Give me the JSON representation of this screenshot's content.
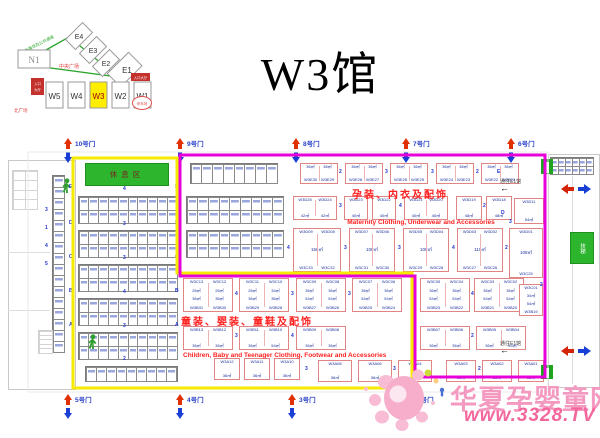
{
  "title": "W3馆",
  "minimap": {
    "halls_diagonal": [
      "E4",
      "E3",
      "E2",
      "E1"
    ],
    "hall_n1": "N1",
    "halls_bottom": [
      "W5",
      "W4",
      "W3",
      "W2",
      "W1"
    ],
    "highlighted": "W3",
    "highlight_color": "#ffee00",
    "green_note": "室外展场及公共通道",
    "plaza_label": "中央广场",
    "corner_label": "北广场",
    "entrance_left_1": "入口",
    "entrance_left_2": "大厅",
    "entrance_right": "入口大厅",
    "oval_label": "停车场"
  },
  "plan": {
    "rest_area": "休息区",
    "escalator": "扶梯",
    "corridor_top": {
      "text": "通往E1馆",
      "arrow": "←"
    },
    "corridor_bottom": {
      "text": "通往E1馆",
      "arrow": "←"
    },
    "categories": {
      "maternity_zh": "孕装、内衣及配饰",
      "maternity_en": "Maternity Clothing, Underwear and Accessories",
      "children_zh": "童装、婴装、童鞋及配饰",
      "children_en": "Children, Baby and Teenager Clothing, Footwear and Accessories"
    },
    "gates_top": [
      {
        "x": 62,
        "label": "10号门"
      },
      {
        "x": 174,
        "label": "9号门"
      },
      {
        "x": 290,
        "label": "8号门"
      },
      {
        "x": 400,
        "label": "7号门"
      },
      {
        "x": 505,
        "label": "6号门"
      }
    ],
    "gates_bottom": [
      {
        "x": 62,
        "label": "5号门"
      },
      {
        "x": 174,
        "label": "4号门"
      },
      {
        "x": 286,
        "label": "3号门"
      },
      {
        "x": 404,
        "label": "2号门"
      }
    ],
    "blocks": [
      {
        "x": 300,
        "y": 163,
        "w": 38,
        "h": 21,
        "cols": [
          {
            "area": "36㎡",
            "bot": "W3E30"
          },
          {
            "area": "36㎡",
            "bot": "W3E29"
          }
        ]
      },
      {
        "x": 345,
        "y": 163,
        "w": 38,
        "h": 21,
        "cols": [
          {
            "area": "36㎡",
            "bot": "W3E28"
          },
          {
            "area": "36㎡",
            "bot": "W3E27"
          }
        ]
      },
      {
        "x": 390,
        "y": 163,
        "w": 38,
        "h": 21,
        "cols": [
          {
            "area": "36㎡",
            "bot": "W3E26"
          },
          {
            "area": "36㎡",
            "bot": "W3E25"
          }
        ]
      },
      {
        "x": 436,
        "y": 163,
        "w": 38,
        "h": 21,
        "cols": [
          {
            "area": "36㎡",
            "bot": "W3E24"
          },
          {
            "area": "36㎡",
            "bot": "W3E23"
          }
        ]
      },
      {
        "x": 481,
        "y": 163,
        "w": 38,
        "h": 21,
        "cols": [
          {
            "area": "36㎡",
            "bot": "W3E22"
          },
          {
            "area": "36㎡",
            "bot": "W3E21"
          }
        ]
      },
      {
        "x": 293,
        "y": 196,
        "w": 44,
        "h": 24,
        "cols": [
          {
            "top": "W3D25",
            "area": "42㎡"
          },
          {
            "top": "W3D24",
            "area": "42㎡"
          }
        ]
      },
      {
        "x": 344,
        "y": 196,
        "w": 24,
        "h": 24,
        "cols": [
          {
            "top": "W3D23",
            "area": "40㎡"
          }
        ]
      },
      {
        "x": 372,
        "y": 196,
        "w": 24,
        "h": 24,
        "cols": [
          {
            "top": "W3D22",
            "area": "40㎡"
          }
        ]
      },
      {
        "x": 404,
        "y": 196,
        "w": 44,
        "h": 24,
        "cols": [
          {
            "top": "W3D21",
            "area": "40㎡"
          },
          {
            "top": "W3D20",
            "area": "40㎡"
          }
        ]
      },
      {
        "x": 456,
        "y": 196,
        "w": 26,
        "h": 24,
        "cols": [
          {
            "top": "W3D19",
            "area": "48㎡"
          }
        ]
      },
      {
        "x": 486,
        "y": 196,
        "w": 26,
        "h": 24,
        "cols": [
          {
            "top": "W3D18",
            "area": "48㎡"
          }
        ]
      },
      {
        "x": 514,
        "y": 198,
        "w": 30,
        "h": 26,
        "cols": [
          {
            "top": "W3D11",
            "area": "54㎡"
          }
        ]
      },
      {
        "x": 293,
        "y": 228,
        "w": 48,
        "h": 44,
        "bigArea": "156㎡",
        "cols": [
          {
            "top": "W3D09",
            "bot": "W3C33"
          },
          {
            "top": "W3D08",
            "bot": "W3C32"
          }
        ]
      },
      {
        "x": 349,
        "y": 228,
        "w": 46,
        "h": 44,
        "bigArea": "108㎡",
        "cols": [
          {
            "top": "W3D07",
            "bot": "W3C31"
          },
          {
            "top": "W3D06",
            "bot": "W3C30"
          }
        ]
      },
      {
        "x": 403,
        "y": 228,
        "w": 46,
        "h": 44,
        "bigArea": "108㎡",
        "cols": [
          {
            "top": "W3D05",
            "bot": "W3C29"
          },
          {
            "top": "W3D04",
            "bot": "W3C28"
          }
        ]
      },
      {
        "x": 457,
        "y": 228,
        "w": 46,
        "h": 44,
        "bigArea": "110㎡",
        "cols": [
          {
            "top": "W3D03",
            "bot": "W3C27"
          },
          {
            "top": "W3D02",
            "bot": "W3C26"
          }
        ]
      },
      {
        "x": 509,
        "y": 228,
        "w": 34,
        "h": 50,
        "bigArea": "108㎡",
        "cols": [
          {
            "top": "W3D01",
            "bot": "W3C25"
          }
        ]
      },
      {
        "x": 183,
        "y": 278,
        "w": 50,
        "h": 34,
        "cols": [
          {
            "top": "W3C13",
            "a1": "26㎡",
            "a2": "36㎡",
            "bot": "W3B31"
          },
          {
            "top": "W3C12",
            "a1": "26㎡",
            "a2": "36㎡",
            "bot": "W3B30"
          }
        ]
      },
      {
        "x": 239,
        "y": 278,
        "w": 50,
        "h": 34,
        "cols": [
          {
            "top": "W3C11",
            "a1": "26㎡",
            "a2": "36㎡",
            "bot": "W3B29"
          },
          {
            "top": "W3C10",
            "a1": "34㎡",
            "a2": "36㎡",
            "bot": "W3B28"
          }
        ]
      },
      {
        "x": 296,
        "y": 278,
        "w": 50,
        "h": 34,
        "cols": [
          {
            "top": "W3C09",
            "a1": "36㎡",
            "a2": "54㎡",
            "bot": "W3B27"
          },
          {
            "top": "W3C08",
            "a1": "36㎡",
            "a2": "54㎡",
            "bot": "W3B26"
          }
        ]
      },
      {
        "x": 352,
        "y": 278,
        "w": 50,
        "h": 34,
        "cols": [
          {
            "top": "W3C07",
            "a1": "36㎡",
            "a2": "54㎡",
            "bot": "W3B25"
          },
          {
            "top": "W3C06",
            "a1": "36㎡",
            "a2": "54㎡",
            "bot": "W3B24"
          }
        ]
      },
      {
        "x": 420,
        "y": 278,
        "w": 50,
        "h": 34,
        "cols": [
          {
            "top": "W3C05",
            "a1": "36㎡",
            "a2": "54㎡",
            "bot": "W3B23"
          },
          {
            "top": "W3C04",
            "a1": "36㎡",
            "a2": "54㎡",
            "bot": "W3B22"
          }
        ]
      },
      {
        "x": 474,
        "y": 278,
        "w": 50,
        "h": 34,
        "cols": [
          {
            "top": "W3C03",
            "a1": "36㎡",
            "a2": "54㎡",
            "bot": "W3B21"
          },
          {
            "top": "W3C02",
            "a1": "36㎡",
            "a2": "54㎡",
            "bot": "W3B20"
          }
        ]
      },
      {
        "x": 519,
        "y": 284,
        "w": 24,
        "h": 32,
        "cols": [
          {
            "top": "W3C01",
            "a1": "34㎡",
            "a2": "54㎡",
            "bot": "W3B19"
          }
        ]
      },
      {
        "x": 183,
        "y": 326,
        "w": 50,
        "h": 24,
        "cols": [
          {
            "top": "W3B13",
            "area": "36㎡"
          },
          {
            "top": "W3B12",
            "area": "36㎡"
          }
        ]
      },
      {
        "x": 239,
        "y": 326,
        "w": 50,
        "h": 24,
        "cols": [
          {
            "top": "W3B11",
            "area": "36㎡"
          },
          {
            "top": "W3B10",
            "area": "54㎡"
          }
        ]
      },
      {
        "x": 296,
        "y": 326,
        "w": 50,
        "h": 24,
        "cols": [
          {
            "top": "W3B09",
            "area": "36㎡"
          },
          {
            "top": "W3B08",
            "area": "36㎡"
          }
        ]
      },
      {
        "x": 420,
        "y": 326,
        "w": 50,
        "h": 24,
        "cols": [
          {
            "top": "W3B07",
            "area": "36㎡"
          },
          {
            "top": "W3B06",
            "area": "36㎡"
          }
        ]
      },
      {
        "x": 476,
        "y": 326,
        "w": 50,
        "h": 24,
        "cols": [
          {
            "top": "W3B05",
            "area": "36㎡"
          },
          {
            "top": "W3B04",
            "area": "54㎡"
          }
        ]
      },
      {
        "x": 214,
        "y": 358,
        "w": 26,
        "h": 22,
        "cols": [
          {
            "top": "W3A12",
            "area": "36㎡"
          }
        ]
      },
      {
        "x": 244,
        "y": 358,
        "w": 26,
        "h": 22,
        "cols": [
          {
            "top": "W3A11",
            "area": "36㎡"
          }
        ]
      },
      {
        "x": 274,
        "y": 358,
        "w": 26,
        "h": 22,
        "cols": [
          {
            "top": "W3A10",
            "area": "36㎡"
          }
        ]
      },
      {
        "x": 318,
        "y": 360,
        "w": 34,
        "h": 22,
        "cols": [
          {
            "top": "W3A08",
            "area": "36㎡"
          }
        ]
      },
      {
        "x": 358,
        "y": 360,
        "w": 34,
        "h": 22,
        "cols": [
          {
            "top": "W3A06",
            "area": "36㎡"
          }
        ]
      },
      {
        "x": 398,
        "y": 360,
        "w": 34,
        "h": 22,
        "cols": [
          {
            "top": "W3A04",
            "area": "36㎡"
          }
        ]
      },
      {
        "x": 446,
        "y": 360,
        "w": 30,
        "h": 22,
        "cols": [
          {
            "top": "W3A03",
            "area": "36㎡"
          }
        ]
      },
      {
        "x": 482,
        "y": 360,
        "w": 30,
        "h": 22,
        "cols": [
          {
            "top": "W3A02",
            "area": "36㎡"
          }
        ]
      },
      {
        "x": 518,
        "y": 360,
        "w": 26,
        "h": 22,
        "cols": [
          {
            "top": "W3A01",
            "area": "36㎡"
          }
        ]
      }
    ],
    "grids": [
      {
        "x": 78,
        "y": 196,
        "w": 100,
        "h": 28,
        "c": 10,
        "r": 2
      },
      {
        "x": 78,
        "y": 230,
        "w": 100,
        "h": 28,
        "c": 10,
        "r": 2
      },
      {
        "x": 78,
        "y": 264,
        "w": 100,
        "h": 28,
        "c": 10,
        "r": 2
      },
      {
        "x": 78,
        "y": 298,
        "w": 100,
        "h": 28,
        "c": 10,
        "r": 2
      },
      {
        "x": 78,
        "y": 332,
        "w": 100,
        "h": 28,
        "c": 10,
        "r": 2
      },
      {
        "x": 85,
        "y": 366,
        "w": 93,
        "h": 16,
        "c": 9,
        "r": 1
      },
      {
        "x": 190,
        "y": 163,
        "w": 88,
        "h": 21,
        "c": 8,
        "r": 1
      },
      {
        "x": 186,
        "y": 196,
        "w": 98,
        "h": 28,
        "c": 9,
        "r": 2
      },
      {
        "x": 186,
        "y": 230,
        "w": 98,
        "h": 28,
        "c": 9,
        "r": 2
      },
      {
        "x": 52,
        "y": 175,
        "w": 13,
        "h": 178,
        "c": 1,
        "r": 16
      },
      {
        "x": 550,
        "y": 157,
        "w": 44,
        "h": 18,
        "c": 6,
        "r": 2
      },
      {
        "x": 12,
        "y": 170,
        "w": 26,
        "h": 40,
        "c": 2,
        "r": 4,
        "light": true
      },
      {
        "x": 38,
        "y": 330,
        "w": 15,
        "h": 24,
        "c": 1,
        "r": 5,
        "light": true
      }
    ],
    "labels": [
      {
        "t": "E",
        "x": 69,
        "y": 185
      },
      {
        "t": "D",
        "x": 69,
        "y": 221
      },
      {
        "t": "C",
        "x": 69,
        "y": 255
      },
      {
        "t": "B",
        "x": 69,
        "y": 289
      },
      {
        "t": "A",
        "x": 69,
        "y": 323
      },
      {
        "t": "E",
        "x": 175,
        "y": 185
      },
      {
        "t": "D",
        "x": 175,
        "y": 221
      },
      {
        "t": "C",
        "x": 175,
        "y": 255
      },
      {
        "t": "B",
        "x": 175,
        "y": 289
      },
      {
        "t": "A",
        "x": 175,
        "y": 323
      },
      {
        "t": "4",
        "x": 123,
        "y": 187
      },
      {
        "t": "3",
        "x": 123,
        "y": 222
      },
      {
        "t": "3",
        "x": 123,
        "y": 256
      },
      {
        "t": "4",
        "x": 123,
        "y": 290
      },
      {
        "t": "3",
        "x": 123,
        "y": 324
      },
      {
        "t": "2",
        "x": 123,
        "y": 357
      },
      {
        "t": "3",
        "x": 45,
        "y": 208
      },
      {
        "t": "1",
        "x": 45,
        "y": 226
      },
      {
        "t": "4",
        "x": 45,
        "y": 244
      },
      {
        "t": "5",
        "x": 45,
        "y": 262
      },
      {
        "t": "2",
        "x": 339,
        "y": 170
      },
      {
        "t": "3",
        "x": 385,
        "y": 170
      },
      {
        "t": "3",
        "x": 431,
        "y": 170
      },
      {
        "t": "2",
        "x": 476,
        "y": 170
      },
      {
        "t": "3",
        "x": 339,
        "y": 204
      },
      {
        "t": "4",
        "x": 399,
        "y": 204
      },
      {
        "t": "2",
        "x": 483,
        "y": 204
      },
      {
        "t": "4",
        "x": 287,
        "y": 246
      },
      {
        "t": "3",
        "x": 344,
        "y": 246
      },
      {
        "t": "3",
        "x": 398,
        "y": 246
      },
      {
        "t": "4",
        "x": 452,
        "y": 246
      },
      {
        "t": "2",
        "x": 505,
        "y": 246
      },
      {
        "t": "4",
        "x": 235,
        "y": 292
      },
      {
        "t": "3",
        "x": 291,
        "y": 292
      },
      {
        "t": "3",
        "x": 348,
        "y": 292
      },
      {
        "t": "4",
        "x": 471,
        "y": 292
      },
      {
        "t": "3",
        "x": 235,
        "y": 334
      },
      {
        "t": "4",
        "x": 291,
        "y": 334
      },
      {
        "t": "2",
        "x": 471,
        "y": 334
      },
      {
        "t": "3",
        "x": 305,
        "y": 367
      },
      {
        "t": "3",
        "x": 393,
        "y": 367
      },
      {
        "t": "2",
        "x": 478,
        "y": 367
      },
      {
        "t": "E",
        "x": 497,
        "y": 170
      },
      {
        "t": "D",
        "x": 501,
        "y": 211
      },
      {
        "t": "3",
        "x": 509,
        "y": 220
      },
      {
        "t": "2",
        "x": 540,
        "y": 283
      }
    ]
  },
  "watermark": {
    "name": "华夏孕婴童网",
    "url": "www.3328.TV",
    "color": "#f4679d"
  }
}
